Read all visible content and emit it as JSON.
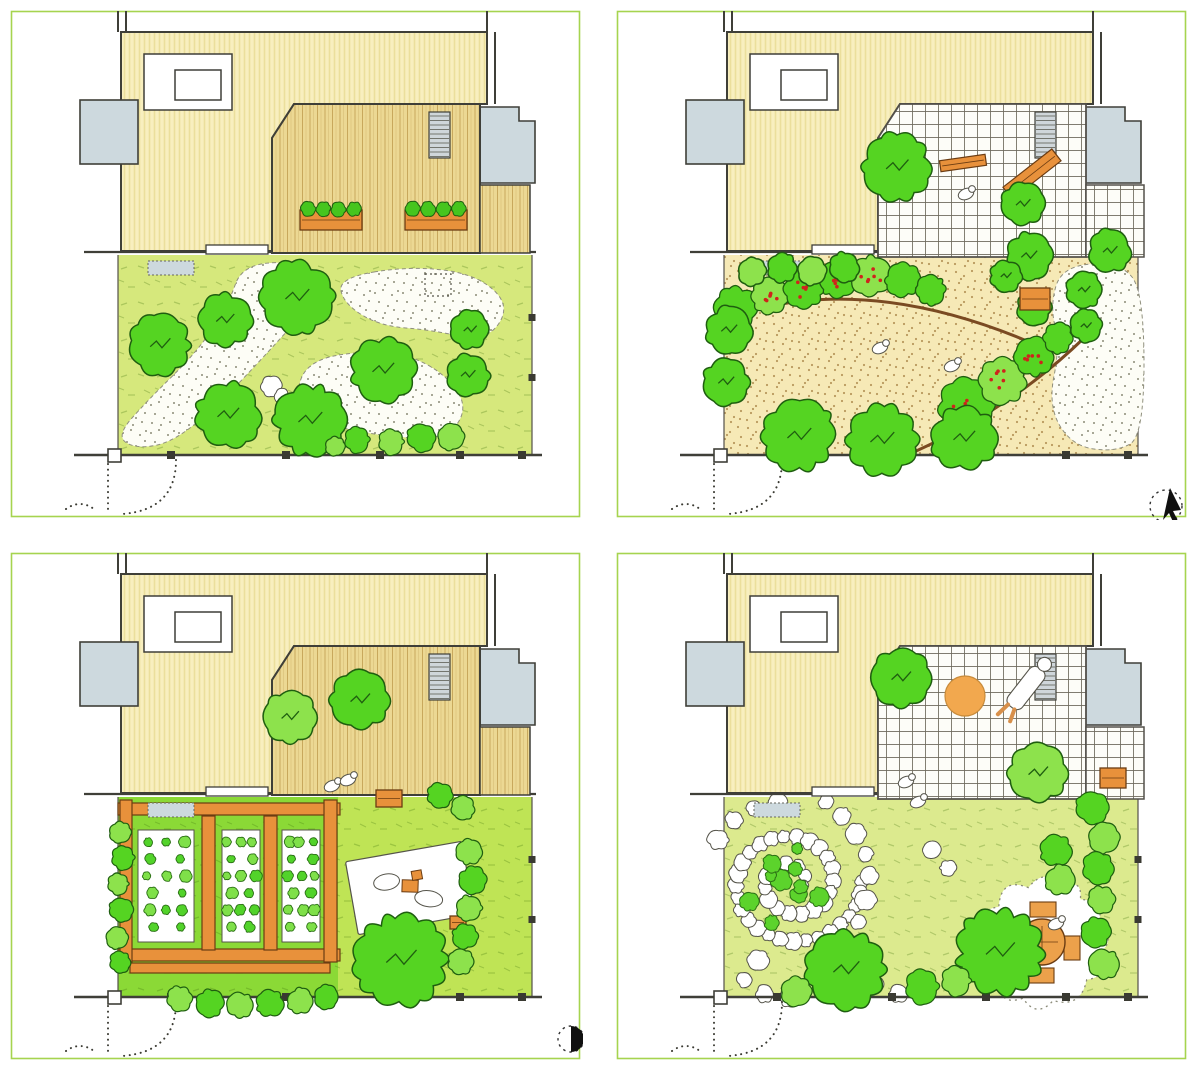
{
  "page": {
    "width": 1197,
    "height": 1080,
    "background": "#ffffff"
  },
  "palette": {
    "frame": "#a6d44f",
    "outline": "#3f3f38",
    "thin_line": "#53504a",
    "house_fill": "#f8efbf",
    "house_stripe": "#ebdf9c",
    "deck_fill": "#ecd893",
    "deck_line": "#c8a85c",
    "gray_box": "#cdd9de",
    "patio_fill": "#fdfdf8",
    "grid_line": "#6e6a5c",
    "tree_fill": "#55d422",
    "tree_light": "#8de24c",
    "tree_stroke": "#1f5e10",
    "orange": "#e8913b",
    "orange_dark": "#6b3c12",
    "table_orange": "#eca14b",
    "berry": "#cf241c",
    "sand": "#f6e9b6",
    "sand_dot": "#b9995e",
    "gravel_dot": "#8c8c78",
    "stone_stroke": "#55544a",
    "brown_curve": "#7a4a22",
    "lawn_tick": "rgba(60,110,10,0.28)"
  },
  "layout": {
    "panel_w": 575,
    "panel_h": 512,
    "positions": [
      [
        8,
        8
      ],
      [
        614,
        8
      ],
      [
        8,
        550
      ],
      [
        614,
        550
      ]
    ]
  },
  "base": {
    "frame": {
      "x": 3.5,
      "y": 3.5,
      "w": 568,
      "h": 505
    },
    "house": {
      "body": "M113,24 H479 V96 H286 L264,130 V243 H113 Z",
      "notch": {
        "x": 136,
        "y": 46,
        "w": 88,
        "h": 56
      },
      "window": {
        "x": 167,
        "y": 62,
        "w": 46,
        "h": 30
      },
      "stubs": [
        [
          110,
          24,
          110,
          3
        ],
        [
          118,
          24,
          118,
          3
        ],
        [
          479,
          24,
          479,
          3
        ],
        [
          487,
          24,
          487,
          96
        ]
      ],
      "left_box": {
        "x": 72,
        "y": 92,
        "w": 58,
        "h": 64
      },
      "right_box": "M447,99 h64 v14 h16 v62 h-80 Z",
      "stairs": {
        "x": 421,
        "y": 104,
        "w": 21,
        "h": 46
      },
      "terrace": {
        "x1": 76,
        "x2": 528,
        "y": 244
      },
      "step": {
        "x": 198,
        "y": 237,
        "w": 62,
        "h": 9
      },
      "mat": {
        "x": 140,
        "y": 253,
        "w": 46,
        "h": 14
      }
    },
    "garden": {
      "x": 110,
      "y": 247,
      "w": 414,
      "h": 200
    },
    "deck": {
      "main": "M286,96 H472 V245 H264 V130 Z",
      "strip": {
        "x": 472,
        "y": 177,
        "w": 50,
        "h": 68
      }
    },
    "patio": {
      "main": "M286,96 H472 V249 H264 V130 Z",
      "strip": {
        "x": 472,
        "y": 177,
        "w": 58,
        "h": 72
      }
    },
    "boundary": {
      "y": 447,
      "x1": 66,
      "x2": 534,
      "posts": [
        163,
        278,
        372,
        452,
        514
      ],
      "gate_post": {
        "x": 100,
        "y": 441,
        "s": 13
      },
      "gate": [
        "M168,452 Q168,502 114,506",
        "M100,456 V504",
        "M58,501 Q72,491 86,501"
      ]
    }
  },
  "panels": [
    {
      "name": "garden-plan-gravel-walk",
      "surface": "deck",
      "deck_items": {
        "planters": [
          [
            292,
            202,
            62,
            20,
            1
          ],
          [
            397,
            202,
            62,
            20,
            1
          ]
        ],
        "trees": [],
        "figures": []
      },
      "ground": {
        "type": "lawn_gravel",
        "lawn": "#d6e87c",
        "gravel": [
          [
            [
              236,
              252
            ],
            [
              318,
              258
            ],
            [
              300,
              300
            ],
            [
              262,
              342
            ],
            [
              215,
              392
            ],
            [
              166,
              434
            ],
            [
              128,
              441
            ],
            [
              108,
              428
            ],
            [
              140,
              392
            ],
            [
              188,
              345
            ],
            [
              219,
              300
            ]
          ],
          [
            [
              330,
              270
            ],
            [
              402,
              258
            ],
            [
              468,
              266
            ],
            [
              503,
              298
            ],
            [
              478,
              334
            ],
            [
              424,
              322
            ],
            [
              372,
              318
            ],
            [
              336,
              296
            ]
          ],
          [
            [
              300,
              352
            ],
            [
              362,
              342
            ],
            [
              420,
              352
            ],
            [
              462,
              394
            ],
            [
              440,
              432
            ],
            [
              372,
              428
            ],
            [
              316,
              416
            ],
            [
              286,
              390
            ]
          ]
        ],
        "dotted_square": [
          417,
          266,
          26,
          22
        ],
        "boulders": [
          [
            263,
            378,
            10
          ],
          [
            274,
            388,
            7
          ]
        ]
      },
      "hedges": [],
      "trees": [
        [
          152,
          337,
          28,
          0
        ],
        [
          217,
          312,
          25,
          0
        ],
        [
          289,
          289,
          33,
          0
        ],
        [
          220,
          407,
          30,
          0
        ],
        [
          302,
          412,
          33,
          0
        ],
        [
          375,
          362,
          30,
          0
        ],
        [
          462,
          322,
          18,
          0
        ],
        [
          460,
          367,
          20,
          0
        ]
      ],
      "shrubs": [
        [
          327,
          438,
          9
        ],
        [
          349,
          432,
          12
        ],
        [
          383,
          434,
          12
        ],
        [
          413,
          430,
          13
        ],
        [
          443,
          429,
          12
        ]
      ],
      "figures": [],
      "planters": [],
      "icon": null
    },
    {
      "name": "garden-plan-sand-path",
      "surface": "patio",
      "deck_items": {
        "benches": [
          [
            418,
            166,
            62,
            15,
            -38
          ],
          [
            349,
            155,
            46,
            11,
            -8
          ]
        ],
        "figures": [
          [
            352,
            186
          ]
        ],
        "trees": [
          [
            283,
            159,
            31,
            0
          ],
          [
            409,
            196,
            20,
            0
          ],
          [
            415,
            248,
            22,
            0
          ],
          [
            496,
            243,
            20,
            0
          ]
        ]
      },
      "ground": {
        "type": "sand",
        "gravel_right": [
          [
            448,
            258
          ],
          [
            506,
            254
          ],
          [
            530,
            284
          ],
          [
            530,
            428
          ],
          [
            502,
            444
          ],
          [
            458,
            438
          ],
          [
            434,
            398
          ],
          [
            446,
            338
          ],
          [
            436,
            298
          ]
        ],
        "curves": [
          "M108,312 Q252,258 438,344",
          "M300,444 Q398,400 470,330"
        ]
      },
      "hedges": [
        {
          "blobs": [
            [
              122,
              300,
              20
            ],
            [
              156,
              288,
              17
            ],
            [
              190,
              280,
              19
            ],
            [
              224,
              272,
              17
            ],
            [
              257,
              268,
              19
            ],
            [
              289,
              272,
              16
            ],
            [
              317,
              282,
              14
            ]
          ],
          "berries": [
            1,
            2,
            3,
            4
          ]
        },
        {
          "blobs": [
            [
              352,
              398,
              26
            ],
            [
              389,
              373,
              22
            ],
            [
              420,
              349,
              18
            ],
            [
              444,
              330,
              14
            ]
          ],
          "berries": [
            0,
            1,
            2
          ]
        }
      ],
      "trees": [
        [
          138,
          264,
          13,
          1
        ],
        [
          168,
          260,
          14,
          0
        ],
        [
          198,
          263,
          13,
          1
        ],
        [
          230,
          259,
          14,
          0
        ],
        [
          115,
          322,
          22,
          0
        ],
        [
          112,
          374,
          22,
          0
        ],
        [
          185,
          428,
          33,
          0
        ],
        [
          268,
          432,
          33,
          0
        ],
        [
          350,
          430,
          30,
          0
        ],
        [
          392,
          268,
          15,
          0
        ],
        [
          420,
          300,
          16,
          0
        ],
        [
          470,
          282,
          17,
          0
        ],
        [
          472,
          318,
          15,
          0
        ]
      ],
      "shrubs": [],
      "figures": [
        [
          266,
          340
        ],
        [
          338,
          358
        ]
      ],
      "planters": [
        [
          406,
          280,
          30,
          22
        ]
      ],
      "icon": {
        "type": "cursor",
        "arrow": "556,480 549,512 555,505 560,516 564,513 559,503 567,502",
        "circle": [
          552,
          498,
          16
        ]
      }
    },
    {
      "name": "garden-plan-vegetable-beds",
      "surface": "deck",
      "deck_items": {
        "trees": [
          [
            282,
            167,
            24,
            1
          ],
          [
            352,
            150,
            27,
            0
          ]
        ],
        "figures": [
          [
            324,
            236
          ],
          [
            340,
            230
          ]
        ],
        "planters": []
      },
      "ground": {
        "type": "veg",
        "lawn_left": "#8bd936",
        "lawn_right": "#bfe455",
        "split_x": 330,
        "beams_h": [
          [
            110,
            253,
            222,
            12
          ],
          [
            110,
            399,
            222,
            12
          ],
          [
            122,
            413,
            200,
            10
          ]
        ],
        "beams_v": [
          [
            112,
            250,
            12,
            162
          ],
          [
            194,
            266,
            13,
            134
          ],
          [
            256,
            266,
            13,
            134
          ],
          [
            316,
            250,
            13,
            162
          ]
        ],
        "beds": [
          [
            130,
            280,
            56,
            112
          ],
          [
            214,
            280,
            38,
            112
          ],
          [
            274,
            280,
            38,
            112
          ]
        ],
        "blanket": {
          "cx": 402,
          "cy": 338,
          "w": 118,
          "h": 74,
          "rot": -10
        },
        "planter_small": [
          442,
          366,
          16,
          13
        ]
      },
      "hedges": [],
      "trees": [
        [
          393,
          410,
          42,
          0
        ]
      ],
      "shrubs": [
        [
          112,
          282,
          10
        ],
        [
          115,
          308,
          11
        ],
        [
          110,
          334,
          10
        ],
        [
          113,
          360,
          11
        ],
        [
          109,
          388,
          10
        ],
        [
          112,
          412,
          10
        ],
        [
          172,
          449,
          12
        ],
        [
          202,
          453,
          13
        ],
        [
          232,
          455,
          12
        ],
        [
          262,
          453,
          13
        ],
        [
          292,
          451,
          12
        ],
        [
          318,
          447,
          11
        ],
        [
          461,
          302,
          12
        ],
        [
          465,
          330,
          13
        ],
        [
          461,
          358,
          12
        ],
        [
          457,
          386,
          12
        ],
        [
          453,
          412,
          12
        ],
        [
          432,
          245,
          12
        ],
        [
          455,
          258,
          11
        ]
      ],
      "figures": [],
      "planters": [
        [
          368,
          240,
          26,
          17
        ]
      ],
      "icon": {
        "type": "halfmoon",
        "c": [
          563,
          489,
          13
        ]
      }
    },
    {
      "name": "garden-plan-leisure-lawn",
      "surface": "patio",
      "deck_items": {
        "trees": [
          [
            287,
            128,
            27,
            0
          ],
          [
            424,
            223,
            27,
            1
          ]
        ],
        "ball": [
          351,
          146,
          20
        ],
        "sunbather": {
          "x": 412,
          "y": 138,
          "rot": 38
        },
        "figures": []
      },
      "ground": {
        "type": "lawn_spiral",
        "lawn": "#dcea8e",
        "spiral": {
          "cx": 178,
          "cy": 332,
          "r": 70
        },
        "trails": [
          [
            [
              212,
              252
            ],
            [
              228,
              266
            ],
            [
              242,
              284
            ],
            [
              252,
              304
            ],
            [
              256,
              326
            ],
            [
              252,
              350
            ],
            [
              244,
              372
            ],
            [
              238,
              394
            ],
            [
              246,
              416
            ],
            [
              262,
              434
            ],
            [
              284,
              444
            ]
          ],
          [
            [
              120,
              270
            ],
            [
              104,
              290
            ],
            [
              140,
              258
            ],
            [
              164,
              252
            ]
          ],
          [
            [
              144,
              410
            ],
            [
              130,
              430
            ],
            [
              150,
              444
            ],
            [
              176,
              448
            ]
          ]
        ],
        "stepping": [
          [
            318,
            300
          ],
          [
            334,
            318
          ]
        ],
        "dining": {
          "cx": 428,
          "cy": 392,
          "r": 58
        }
      },
      "hedges": [],
      "trees": [
        [
          232,
          420,
          36,
          0
        ],
        [
          386,
          402,
          40,
          0
        ]
      ],
      "shrubs": [
        [
          182,
          441,
          14
        ],
        [
          308,
          437,
          16
        ],
        [
          342,
          431,
          14
        ],
        [
          478,
          258,
          15
        ],
        [
          490,
          288,
          14
        ],
        [
          484,
          318,
          15
        ],
        [
          488,
          350,
          13
        ],
        [
          482,
          382,
          14
        ],
        [
          490,
          414,
          14
        ],
        [
          442,
          300,
          15
        ],
        [
          446,
          330,
          14
        ]
      ],
      "figures": [
        [
          292,
          232
        ],
        [
          304,
          252
        ]
      ],
      "planters": [
        [
          486,
          218,
          26,
          20
        ]
      ],
      "icon": null
    }
  ]
}
